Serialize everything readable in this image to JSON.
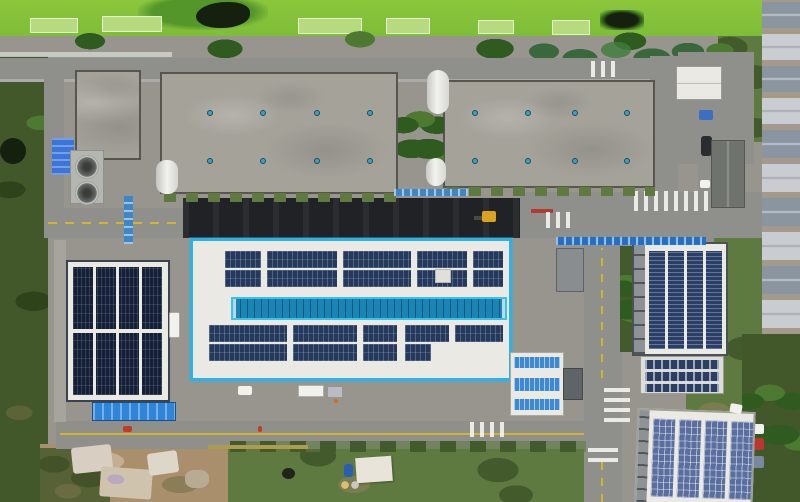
{
  "scene": {
    "description": "Aerial drone photo of an industrial park: two gray factory roofs at top, a white-roofed factory outlined in cyan at center covered with rooftop solar arrays and a blue skylight monitor, a dark solar-covered building at left, two solar-roofed buildings at right, roads with zebra crossings, green algae pond strip at top, scrub and dirt lots at bottom",
    "regions": [
      "algae-pond",
      "tree-band",
      "factory-roof-left",
      "factory-roof-right",
      "highlighted-solar-building",
      "skylight-monitor",
      "left-solar-building",
      "right-upper-solar-building",
      "right-lower-solar-building",
      "solar-annex",
      "roads",
      "crosswalks",
      "scrub-lots",
      "row-houses"
    ]
  },
  "palette": {
    "campus": "#97958d",
    "algae": "#8cc63c",
    "algae_dark": "#55962a",
    "water_dark": "#15200e",
    "bed_light": "#b7da7e",
    "tree": "#2f5a20",
    "tree_light": "#4d7a30",
    "scrub": "#42582a",
    "scrub_dark": "#2c431b",
    "lawn": "#5f7a40",
    "lawn_dark": "#435a2c",
    "dirt": "#a98f6b",
    "dirt_light": "#c4b090",
    "road": "#8f908c",
    "asphalt": "#202225",
    "concrete": "#a5a29a",
    "concrete_dark": "#57564e",
    "roof_white": "#ebe9e4",
    "wall_gray": "#8e9297",
    "vent_blue": "#37a3c6",
    "highlight": "#2cb2e6",
    "sky_border": "#38c2f0",
    "sky_blue": "#1a85b5",
    "pv_center": "#27395a",
    "pv_dark": "#161f33",
    "pv_mid": "#2b3e63",
    "pv_light": "#5a6f9f",
    "pv_bright": "#3e8ad2",
    "canopy": "#2f85d8",
    "walkway_blue": "#2470c4",
    "crane_blue": "#3f86c8",
    "excavator": "#d8a31f",
    "yellow": "#d4b32e",
    "red": "#c23a28",
    "orange": "#d07020",
    "white": "#f1f2ee",
    "silver": "#c9cdd2",
    "house_blue": "#8b95a0",
    "truck_blue": "#3d6fc0",
    "fan_gray": "#6a6e6a",
    "pad_gray": "#b4b6b0",
    "tarp": "#d8cfc2"
  }
}
